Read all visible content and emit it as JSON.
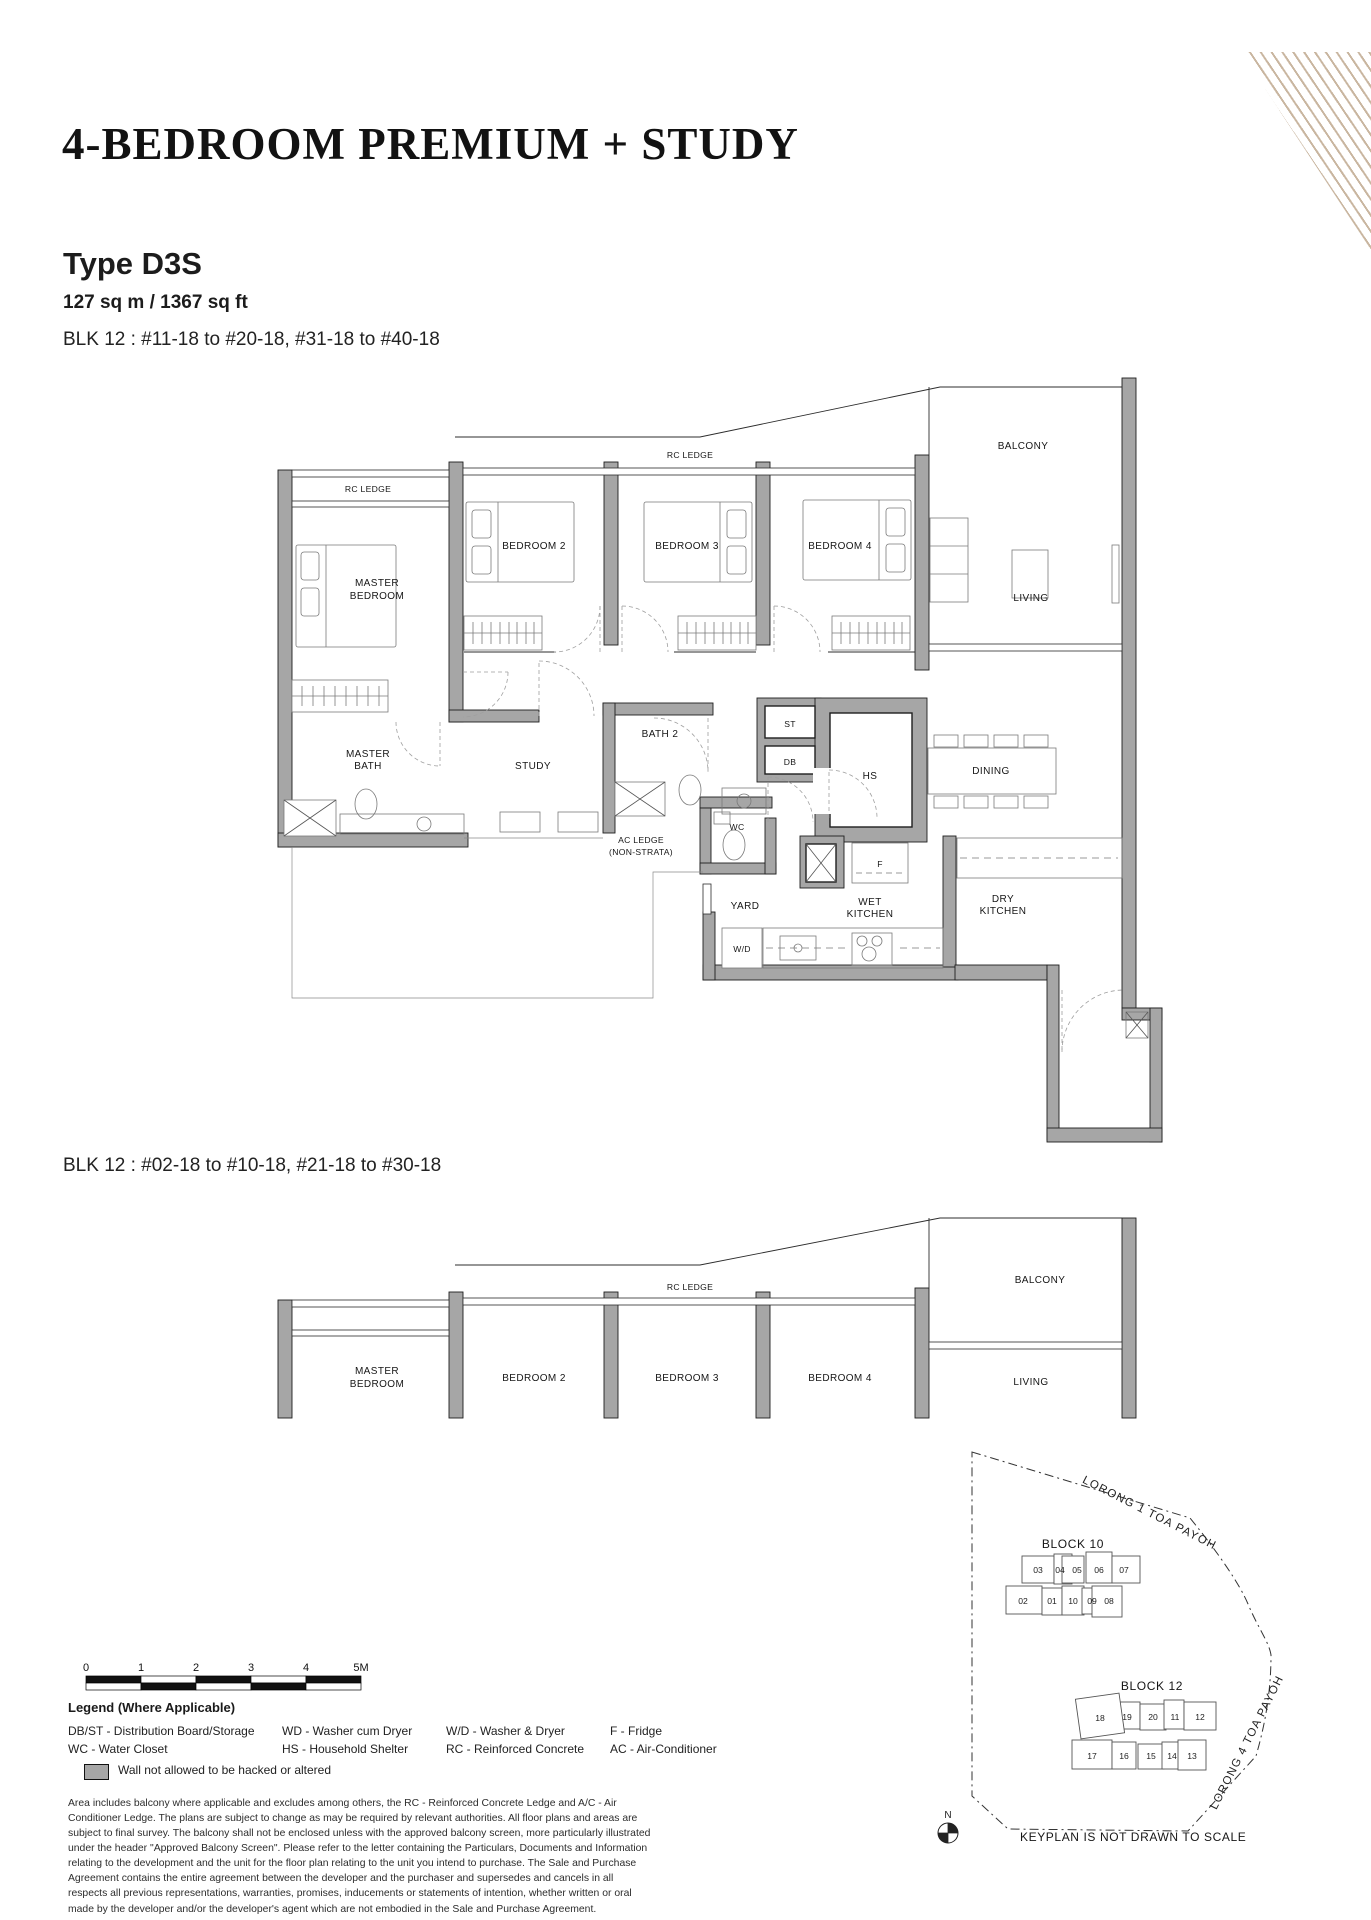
{
  "header": {
    "title": "4-BEDROOM PREMIUM + STUDY",
    "type": "Type D3S",
    "area": "127 sq m / 1367 sq ft",
    "blk_top": "BLK 12 : #11-18 to #20-18, #31-18 to #40-18",
    "blk_bottom": "BLK 12 : #02-18 to #10-18, #21-18 to #30-18"
  },
  "plan": {
    "rc_ledge": "RC LEDGE",
    "master_bedroom": [
      "MASTER",
      "BEDROOM"
    ],
    "bedroom2": "BEDROOM 2",
    "bedroom3": "BEDROOM 3",
    "bedroom4": "BEDROOM 4",
    "balcony": "BALCONY",
    "living": "LIVING",
    "master_bath": [
      "MASTER",
      "BATH"
    ],
    "study": "STUDY",
    "bath2": "BATH 2",
    "st": "ST",
    "db": "DB",
    "hs": "HS",
    "wc": "WC",
    "dining": "DINING",
    "ac_ledge": [
      "AC LEDGE",
      "(NON-STRATA)"
    ],
    "yard": "YARD",
    "wet_kitchen": [
      "WET",
      "KITCHEN"
    ],
    "dry_kitchen": [
      "DRY",
      "KITCHEN"
    ],
    "wd": "W/D",
    "f": "F"
  },
  "keyplan": {
    "block10": {
      "label": "BLOCK 10",
      "row1": [
        "03",
        "04",
        "05",
        "06",
        "07"
      ],
      "row2": [
        "02",
        "01",
        "10",
        "09",
        "08"
      ]
    },
    "block12": {
      "label": "BLOCK 12",
      "row1": [
        "18",
        "19",
        "20",
        "11",
        "12"
      ],
      "row2": [
        "17",
        "16",
        "15",
        "14",
        "13"
      ],
      "highlighted_unit": "18"
    },
    "road1": "LORONG 1 TOA PAYOH",
    "road2": "LORONG 4 TOA PAYOH",
    "north": "N",
    "note": "KEYPLAN IS NOT DRAWN TO SCALE"
  },
  "scalebar": {
    "labels": [
      "0",
      "1",
      "2",
      "3",
      "4",
      "5M"
    ]
  },
  "legend": {
    "heading": "Legend (Where Applicable)",
    "columns": [
      [
        "DB/ST - Distribution Board/Storage",
        "WC - Water Closet"
      ],
      [
        "WD - Washer cum Dryer",
        "HS - Household Shelter"
      ],
      [
        "W/D - Washer & Dryer",
        "RC - Reinforced Concrete"
      ],
      [
        "F - Fridge",
        "AC - Air-Conditioner"
      ]
    ],
    "wall_note": "Wall not allowed to be hacked or altered"
  },
  "disclaimer": "Area includes balcony where applicable and excludes among others, the RC - Reinforced Concrete Ledge and A/C - Air Conditioner Ledge. The plans are subject to change as may be required by relevant authorities. All floor plans and areas are subject to final survey. The balcony shall not be enclosed unless with the approved balcony screen, more particularly illustrated under the header \"Approved Balcony Screen\". Please refer to the letter containing the Particulars, Documents and Information relating to the development and the unit for the floor plan relating to the unit you intend to purchase. The Sale and Purchase Agreement contains the entire agreement between the developer and the purchaser and supersedes and cancels in all respects all previous representations, warranties, promises, inducements or statements of intention, whether written or oral made by the developer and/or the developer's agent which are not embodied in the Sale and Purchase Agreement.",
  "colors": {
    "wall": "#a6a6a6",
    "keyplan_highlight": "#a6917c",
    "decor_stripe": "#c9b6a0"
  }
}
